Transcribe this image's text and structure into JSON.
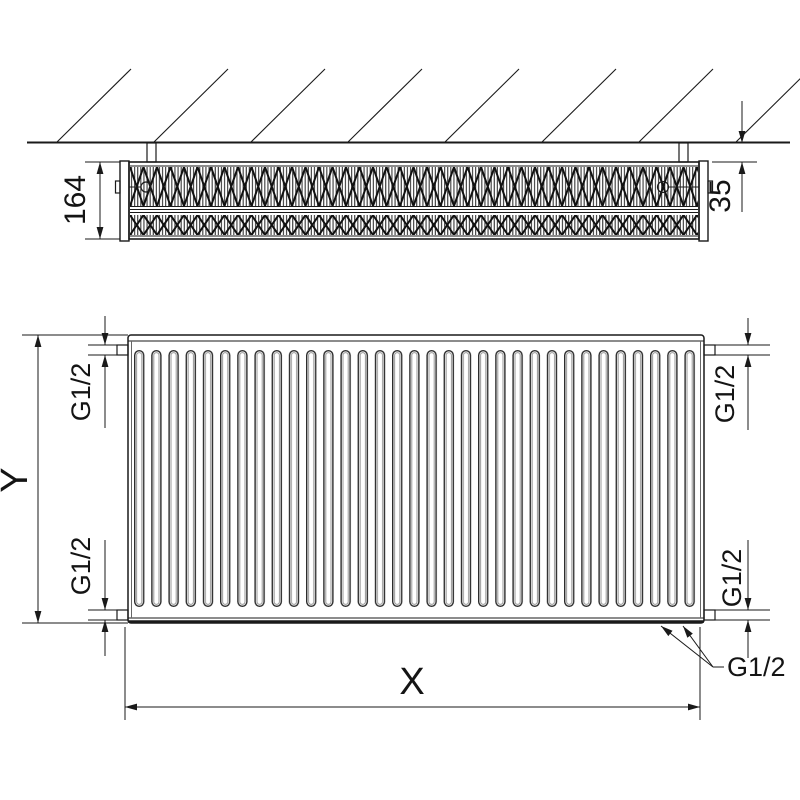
{
  "drawing": {
    "top_view": {
      "depth": "164",
      "wall_clearance": "35"
    },
    "front_view": {
      "height": "Y",
      "width": "X",
      "conn_top_left": "G1/2",
      "conn_bottom_left": "G1/2",
      "conn_top_right": "G1/2",
      "conn_bottom_right": "G1/2",
      "conn_callout": "G1/2"
    },
    "colors": {
      "line": "#1a1a1a",
      "background": "#ffffff"
    }
  }
}
